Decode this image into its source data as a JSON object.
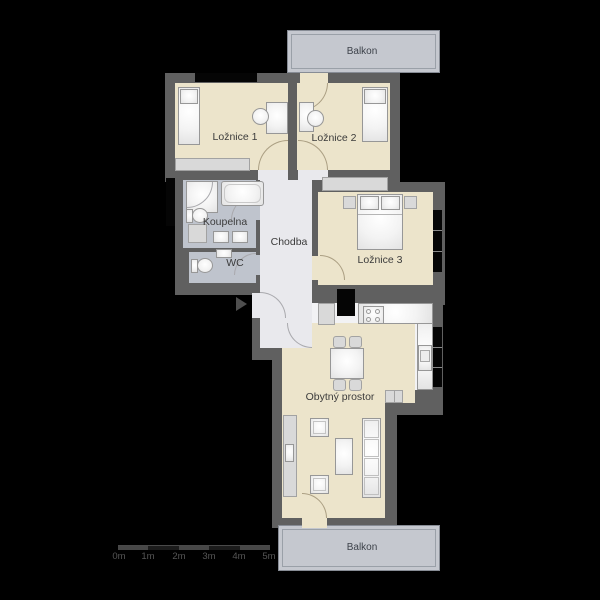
{
  "plan_title": "Apartment floor plan",
  "rooms": {
    "loznice1": "Ložnice 1",
    "loznice2": "Ložnice 2",
    "loznice3": "Ložnice 3",
    "koupelna": "Koupelna",
    "wc": "WC",
    "chodba": "Chodba",
    "obytny": "Obytný prostor",
    "balkon_top": "Balkon",
    "balkon_bottom": "Balkon"
  },
  "scale_labels": [
    "0m",
    "1m",
    "2m",
    "3m",
    "4m",
    "5m"
  ],
  "colors": {
    "background": "#000000",
    "wall": "#606060",
    "floor_room": "#ece4cb",
    "floor_bath": "#bfc4cd",
    "floor_hall": "#e9e9ed",
    "balcony": "#c5c8cf",
    "label_text": "#3b3b3b"
  }
}
